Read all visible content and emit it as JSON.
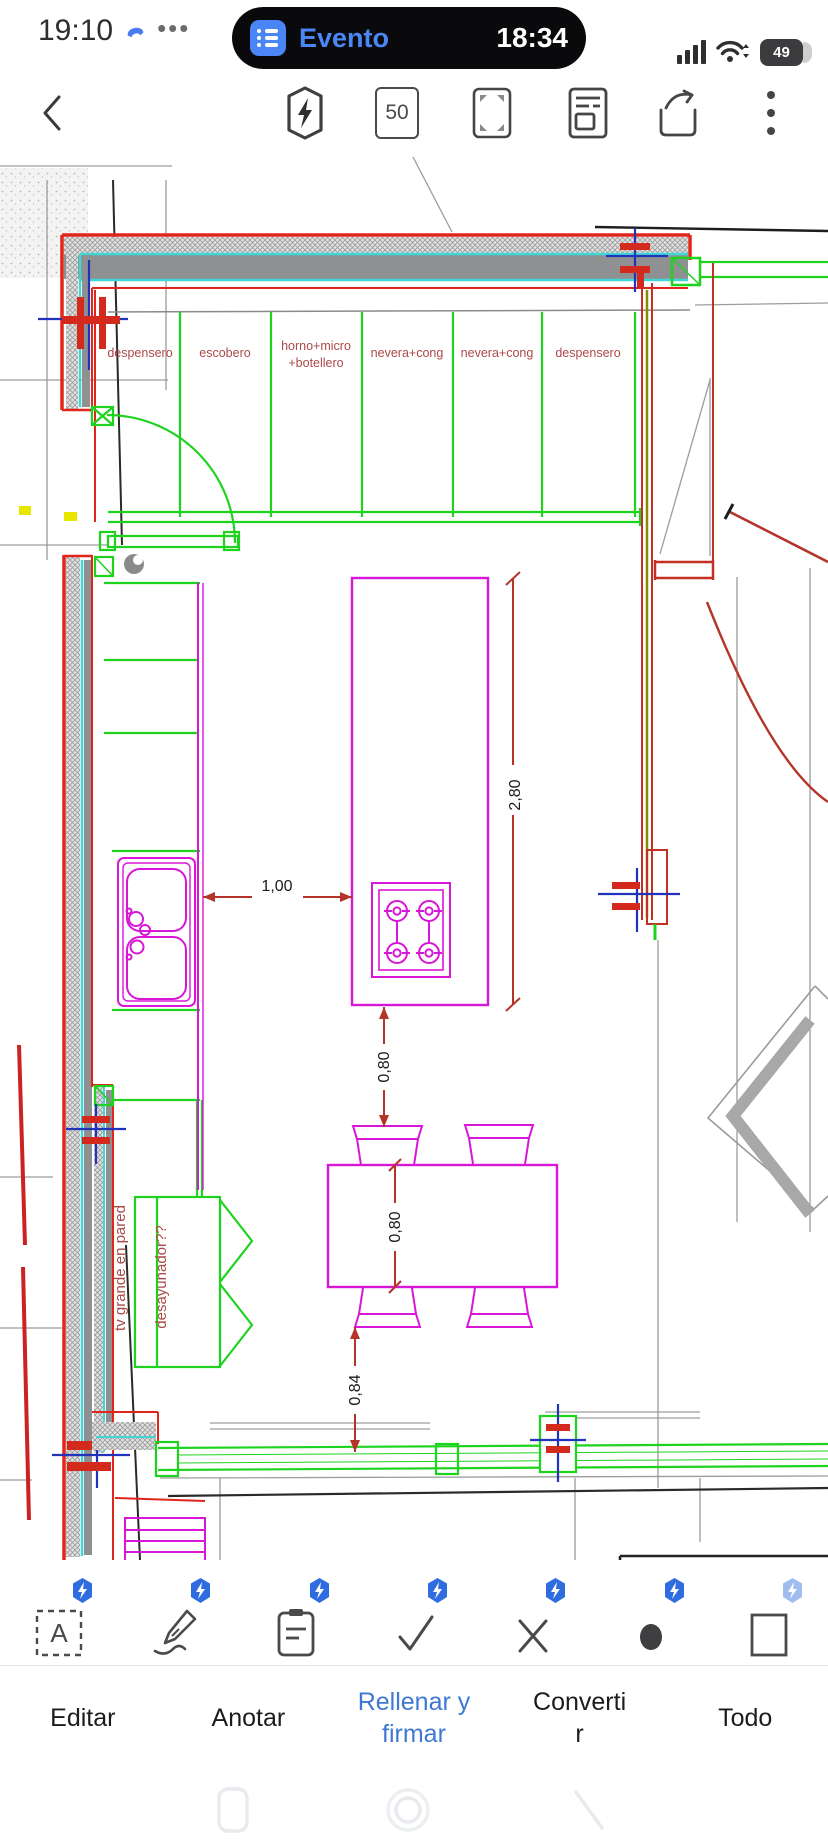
{
  "status_bar": {
    "time": "19:10",
    "ellipsis": "•••",
    "notification": {
      "app_label": "Evento",
      "time": "18:34"
    },
    "battery_percent": "49"
  },
  "toolbar": {
    "page_indicator": "50"
  },
  "plan": {
    "cabinet_labels": [
      "despensero",
      "escobero",
      "horno+micro",
      "+botellero",
      "nevera+cong",
      "nevera+cong",
      "despensero"
    ],
    "annotations": {
      "tv": "tv grande en pared",
      "breakfast": "desayunador??"
    },
    "dimensions": {
      "island_length": "2,80",
      "walkway": "1,00",
      "island_to_table": "0,80",
      "table_width": "0,80",
      "table_to_window": "0,84"
    },
    "colors": {
      "cad_red": "#e0251a",
      "cad_green": "#1ed31e",
      "cad_magenta": "#d816d8",
      "cad_cyan": "#3fd6d6",
      "dim_red": "#b5342a",
      "label_red": "#ab4a48"
    }
  },
  "bottom_toolbar": {
    "tabs": [
      {
        "label": "Editar",
        "active": false
      },
      {
        "label": "Anotar",
        "active": false
      },
      {
        "label": "Rellenar y firmar",
        "active": true
      },
      {
        "label": "Convertir",
        "active": false
      },
      {
        "label": "Todo",
        "active": false
      }
    ],
    "tool_letter": "A",
    "accent": "#3e78d2"
  }
}
